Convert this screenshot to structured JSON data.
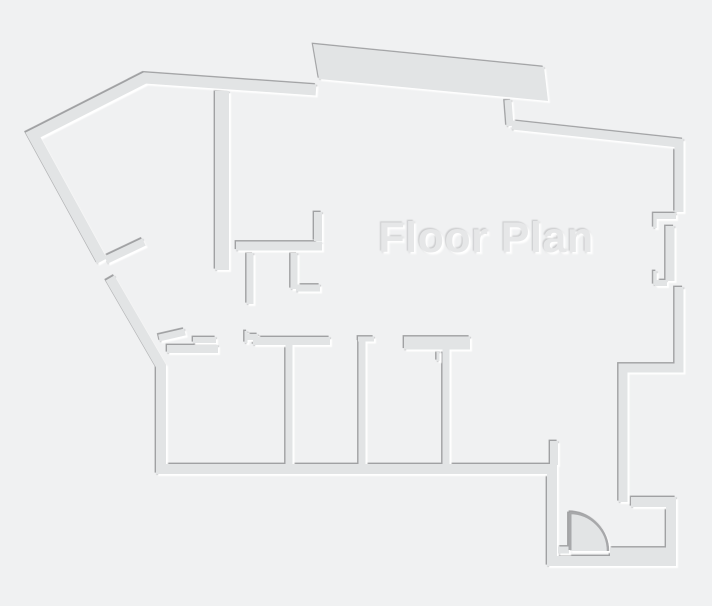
{
  "title": "Floor Plan",
  "colors": {
    "background": "#f0f1f2",
    "wall": "#e2e4e5",
    "wall_shadow": "#9b9c9e",
    "wall_highlight": "#ffffff",
    "title_fill": "#e6e7e8",
    "title_shadow": "#c8c9ca",
    "door_line": "#a7a8aa"
  },
  "title_position": {
    "x": 486,
    "y": 252,
    "font_size": 43
  },
  "floor_plan": {
    "slab": {
      "name": "top-bay-slab",
      "points": "313,44 544,67 548,101 319,79"
    },
    "segments": [
      {
        "name": "top-left-outer-wall",
        "d": "M316,90 L145,78 L33,135 L102,261",
        "w": 11
      },
      {
        "name": "left-lower-outer-wall",
        "d": "M110,278 L161,366 L161,469 L552,469 L552,561 L671,561 L671,502 L631,502",
        "w": 10
      },
      {
        "name": "bay-connector-wall",
        "d": "M508,100 L510,126",
        "w": 7
      },
      {
        "name": "top-right-diagonal-wall",
        "d": "M512,125 L679,143 L679,212",
        "w": 9
      },
      {
        "name": "right-wall-middle",
        "d": "M670,226 L670,281",
        "w": 9
      },
      {
        "name": "right-wall-lower-step",
        "d": "M679,287 L679,368 L623,368 L623,502",
        "w": 9
      },
      {
        "name": "vestibule-inner-bottom",
        "d": "M610,552 L671,552",
        "w": 9
      },
      {
        "name": "right-jamb-a-horizontal",
        "d": "M655,216 L676,216",
        "w": 6
      },
      {
        "name": "right-jamb-a-tick",
        "d": "M655,213 L655,228",
        "w": 3.5
      },
      {
        "name": "right-jamb-b-tick",
        "d": "M655,271 L655,285",
        "w": 3.5
      },
      {
        "name": "right-jamb-b-horizontal",
        "d": "M655,283 L667,283",
        "w": 6
      },
      {
        "name": "upper-thick-interior-wall",
        "d": "M222,91 L222,270",
        "w": 14
      },
      {
        "name": "counter-wall",
        "d": "M236,246 L322,246",
        "w": 9
      },
      {
        "name": "counter-stub-up",
        "d": "M318,212 L318,241",
        "w": 8
      },
      {
        "name": "alcove-prong-left",
        "d": "M250,253 L250,304",
        "w": 7
      },
      {
        "name": "alcove-prong-right",
        "d": "M294,253 L294,289",
        "w": 7
      },
      {
        "name": "alcove-l-piece",
        "d": "M296,288 L320,288",
        "w": 7
      },
      {
        "name": "diagonal-door-stub",
        "d": "M106,260 L144,242",
        "w": 8
      },
      {
        "name": "corner-door-stub",
        "d": "M159,338 L185,332",
        "w": 7
      },
      {
        "name": "floating-jamb-stub",
        "d": "M193,340 L216,340",
        "w": 6
      },
      {
        "name": "room-a-top-wall",
        "d": "M167,349 L218,349",
        "w": 8
      },
      {
        "name": "room-b-jamb-tick",
        "d": "M246,331 L246,343",
        "w": 3
      },
      {
        "name": "room-b-jamb-horizontal",
        "d": "M246,337 L258,337",
        "w": 6
      },
      {
        "name": "room-b-top-wall",
        "d": "M253,341 L330,341",
        "w": 8
      },
      {
        "name": "room-c-jamb",
        "d": "M358,339 L374,339",
        "w": 5
      },
      {
        "name": "room-c-divider-wall",
        "d": "M362,341 L362,464",
        "w": 7
      },
      {
        "name": "room-d-top-wall",
        "d": "M404,343 L470,343",
        "w": 13
      },
      {
        "name": "room-d-divider-wall",
        "d": "M446,349 L446,464",
        "w": 7
      },
      {
        "name": "room-d-jamb-tick",
        "d": "M438,351 L438,361",
        "w": 3
      },
      {
        "name": "room-ab-divider-wall",
        "d": "M289,345 L289,464",
        "w": 7
      },
      {
        "name": "vestibule-entry-stub",
        "d": "M554,441 L554,465",
        "w": 8
      },
      {
        "name": "door-hinge-jamb",
        "d": "M558,550 L569,550",
        "w": 7
      }
    ],
    "door": {
      "panel_d": "M570,513 A38,38 0 0 1 608,551 L570,551 Z",
      "swing_d": "M570,513 A38,38 0 0 1 608,551",
      "leaf_d": "M570,513 L570,550"
    }
  }
}
